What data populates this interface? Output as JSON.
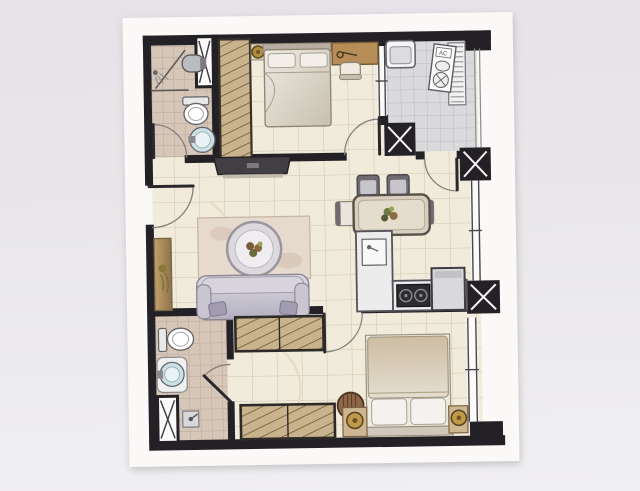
{
  "image": {
    "kind": "photograph of an architectural floor plan drawing on white paper",
    "background_surface_color": "#e9e7ea",
    "paper_color": "#faf9f8"
  },
  "labels": {
    "ac_unit": "AC"
  },
  "colors": {
    "wall": "#232125",
    "floor_cream_tile": "#f1ebdb",
    "bathroom_tile": "#d6c6b8",
    "balcony_gray_tile": "#dadadd",
    "wardrobe_wood": "#c9b38c",
    "desk_wood": "#b68d57",
    "gold_lamp": "#b08f3e",
    "sofa_fabric": "#c6c2d0",
    "stove_black": "#2e2c31",
    "basin_blue": "#cfe0e4"
  },
  "floor_plan": {
    "rooms": [
      {
        "name": "master bathroom",
        "position": "top-left",
        "fixtures": [
          "corner shower with swing door",
          "wall-hung basin",
          "toilet",
          "round pedestal sink",
          "duct shaft"
        ]
      },
      {
        "name": "master bedroom",
        "position": "top-center",
        "furniture": [
          "double bed with two pillows",
          "bedside shelf with gold lamp",
          "wood desk",
          "chair",
          "tall hatched wardrobe"
        ]
      },
      {
        "name": "utility balcony",
        "position": "top-right",
        "fixtures": [
          "laundry sink unit",
          "AC outdoor unit with fan",
          "louver vent panel",
          "railing"
        ]
      },
      {
        "name": "living room",
        "position": "middle-left",
        "furniture": [
          "dark TV console on north wall",
          "sideboard with plant on west wall",
          "square rug",
          "round tray coffee table",
          "three-seat sofa with two cushions"
        ]
      },
      {
        "name": "dining area",
        "position": "middle-right",
        "furniture": [
          "rectangular dining table with centerpiece",
          "two dark chairs north side",
          "two light chairs east and west"
        ]
      },
      {
        "name": "kitchen",
        "position": "right",
        "fixtures": [
          "L-shaped counter",
          "sink with faucet",
          "two-burner stove",
          "refrigerator"
        ]
      },
      {
        "name": "bedroom 2",
        "position": "bottom-center",
        "furniture": [
          "double bed, headboard on south wall",
          "two nightstands with gold lamps",
          "hatched wardrobe north",
          "hatched wardrobe south",
          "round laundry basket"
        ]
      },
      {
        "name": "bathroom 2",
        "position": "bottom-left",
        "fixtures": [
          "toilet",
          "round basin vanity",
          "shower stall marked with X",
          "small mop basin"
        ]
      }
    ],
    "structure": {
      "columns_with_x": 3,
      "duct_shafts_with_x": 2,
      "doors": [
        "entry door on west wall",
        "master bathroom door",
        "master bedroom door",
        "balcony door from kitchen",
        "bedroom 2 door",
        "bathroom 2 door"
      ],
      "windows": [
        "master bedroom east window",
        "kitchen east window",
        "bedroom 2 east window",
        "balcony louver and railing"
      ]
    }
  }
}
